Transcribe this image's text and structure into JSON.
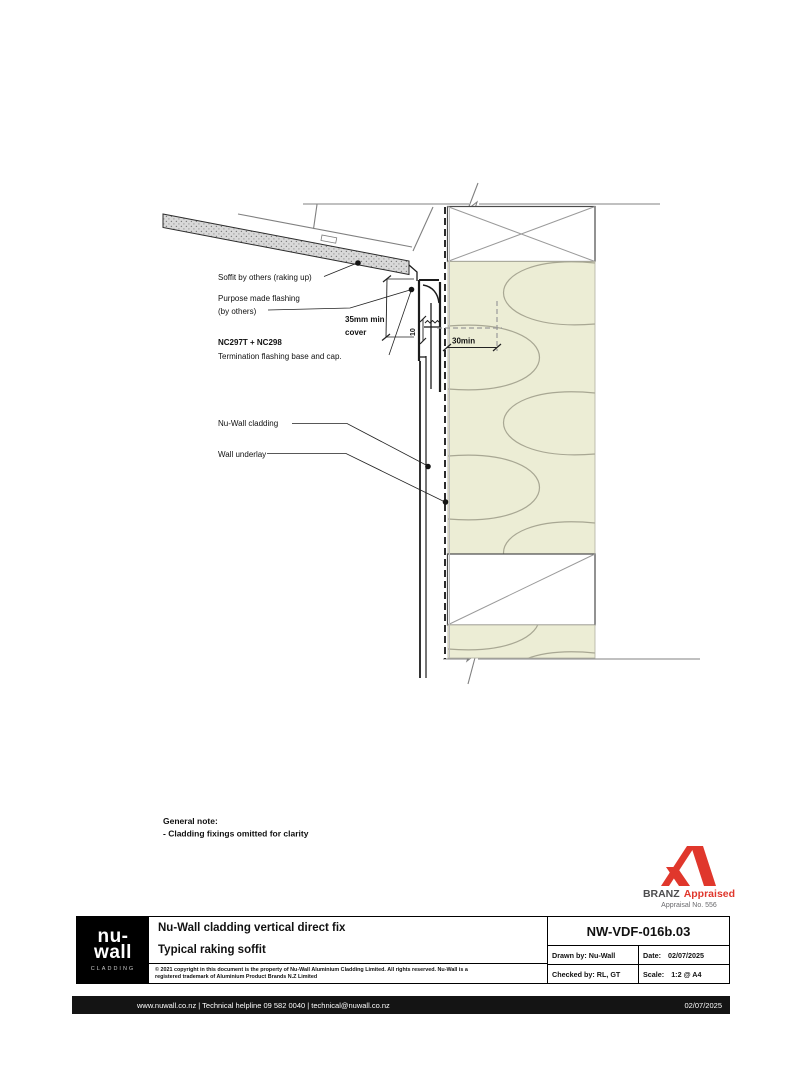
{
  "drawing": {
    "labels": {
      "soffit": "Soffit by others (raking up)",
      "purpose_flashing_1": "Purpose made flashing",
      "purpose_flashing_2": "(by others)",
      "cover_dim_1": "35mm min",
      "cover_dim_2": "cover",
      "product_code": "NC297T + NC298",
      "product_desc": "Termination flashing base and cap.",
      "cladding": "Nu-Wall cladding",
      "underlay": "Wall underlay",
      "dim_30": "30min",
      "dim_10": "10"
    },
    "general_note": {
      "title": "General note:",
      "item": "- Cladding fixings omitted for clarity"
    }
  },
  "branz": {
    "brand": "BRANZ",
    "appraised": "Appraised",
    "appraisal_no": "Appraisal No. 556"
  },
  "title_block": {
    "logo": {
      "line1": "nu-",
      "line2": "wall",
      "sub": "CLADDING"
    },
    "title": "Nu-Wall cladding vertical direct fix",
    "subtitle": "Typical raking soffit",
    "copyright_1": "© 2021 copyright in this document is the property of Nu-Wall Aluminium Cladding Limited. All rights reserved. Nu-Wall is a",
    "copyright_2": "registered trademark of Aluminium Product Brands N.Z Limited",
    "drawing_number": "NW-VDF-016b.03",
    "drawn_by_label": "Drawn by:",
    "drawn_by": "Nu-Wall",
    "date_label": "Date:",
    "date": "02/07/2025",
    "checked_by_label": "Checked by:",
    "checked_by": "RL, GT",
    "scale_label": "Scale:",
    "scale": "1:2 @ A4"
  },
  "footer": {
    "links": "www.nuwall.co.nz  |  Technical helpline 09 582 0040  |  technical@nuwall.co.nz",
    "date": "02/07/2025"
  },
  "colors": {
    "insulation_fill": "#ECEDD5",
    "branz_red": "#E0372C",
    "line_gray": "#808080",
    "footer_bg": "#141414"
  }
}
